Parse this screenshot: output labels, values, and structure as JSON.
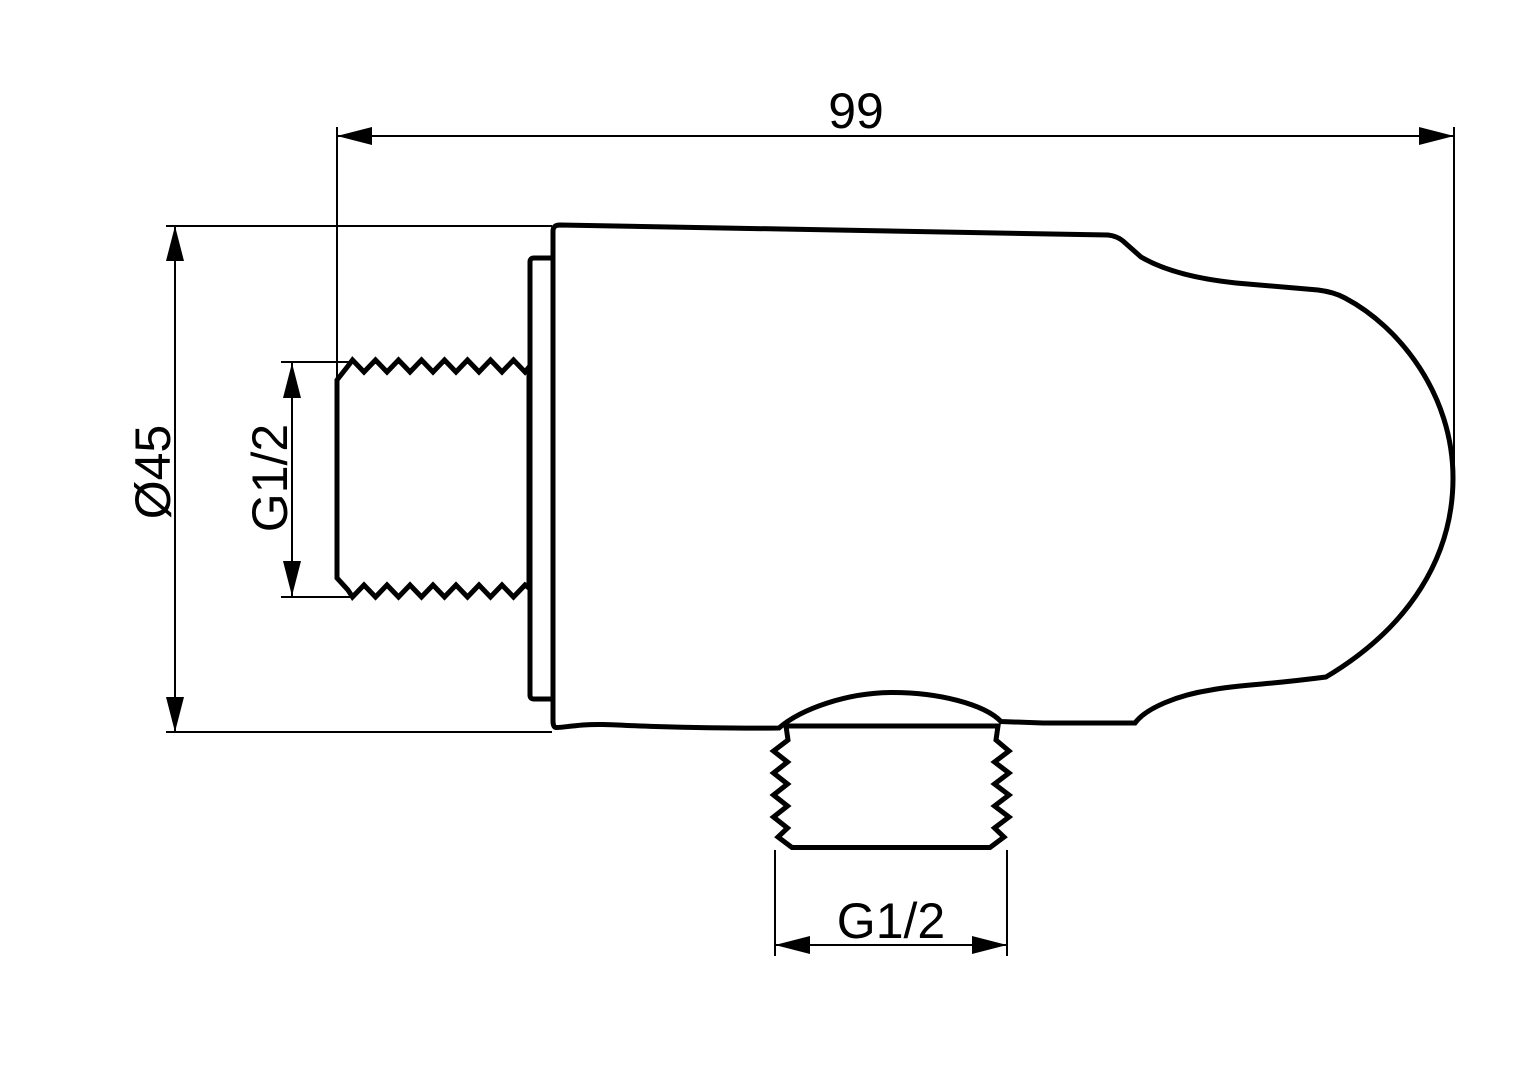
{
  "colors": {
    "background": "#ffffff",
    "line": "#000000"
  },
  "drawing": {
    "view": "side-profile-technical-drawing",
    "dimensions": {
      "overall_length": {
        "label": "99",
        "orientation": "horizontal"
      },
      "diameter": {
        "label": "Ø45",
        "orientation": "vertical"
      },
      "inlet_thread": {
        "label": "G1/2",
        "orientation": "vertical"
      },
      "outlet_thread": {
        "label": "G1/2",
        "orientation": "horizontal"
      }
    }
  }
}
